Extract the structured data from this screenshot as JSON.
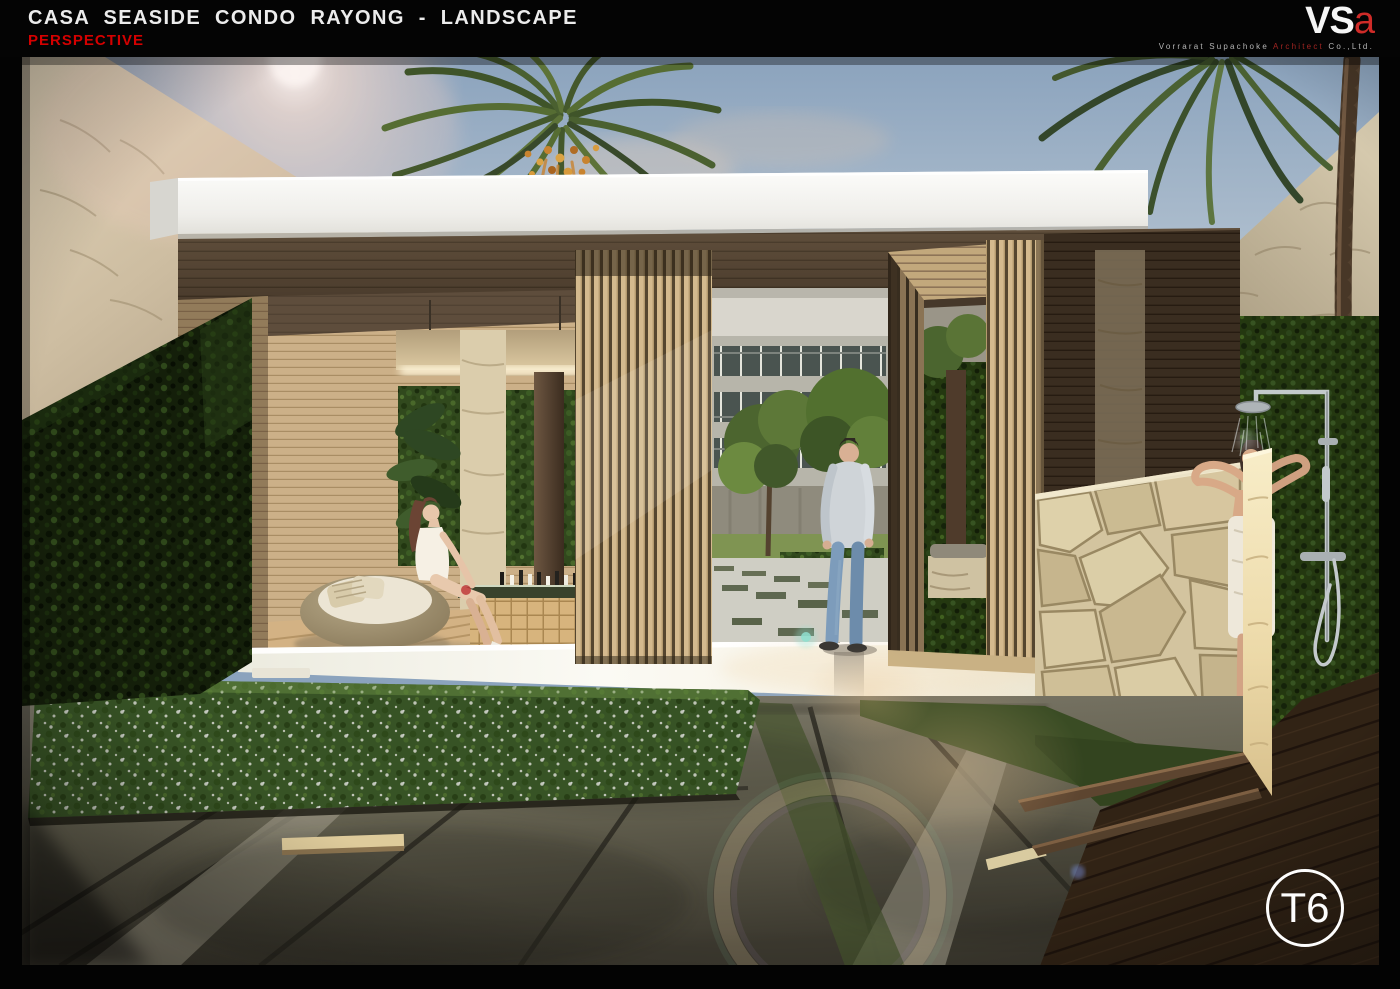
{
  "header": {
    "title": "CASA SEASIDE CONDO RAYONG - LANDSCAPE",
    "subtitle": "PERSPECTIVE"
  },
  "logo": {
    "mark_primary": "VS",
    "mark_accent": "a",
    "company_prefix": "Vorrarat Supachoke",
    "company_accent": "Architect",
    "company_suffix": "Co.,Ltd."
  },
  "badge": {
    "label": "T6"
  },
  "colors": {
    "accent_red": "#d40000",
    "logo_accent_red": "#cf2b28",
    "sheet_background": "#040404",
    "badge_stroke": "#fdfdfd"
  }
}
